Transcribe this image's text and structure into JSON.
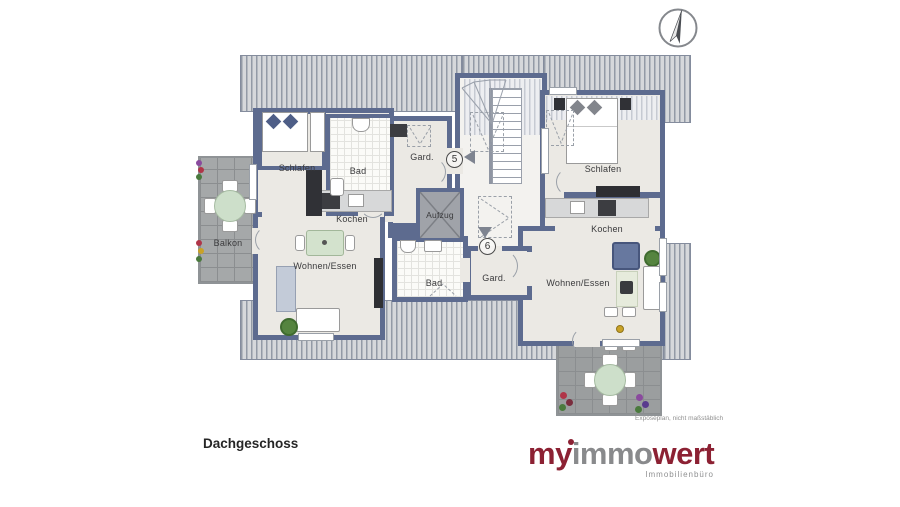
{
  "plan": {
    "floor_label": "Dachgeschoss",
    "caption": "Exposéplan, nicht maßstäblich",
    "core": {
      "elevator_label": "Aufzug"
    },
    "apartment_5": {
      "unit_number": "5",
      "schlafen": "Schlafen",
      "bad": "Bad",
      "kochen": "Kochen",
      "gard": "Gard.",
      "wohnen": "Wohnen/Essen",
      "balkon": "Balkon"
    },
    "apartment_6": {
      "unit_number": "6",
      "schlafen": "Schlafen",
      "bad": "Bad",
      "kochen": "Kochen",
      "gard": "Gard.",
      "wohnen": "Wohnen/Essen"
    },
    "colors": {
      "wall": "#5d6b8f",
      "floor": "#ebe9e4",
      "roof_stripe": "#939aa6",
      "brand_red": "#8c2133"
    }
  },
  "logo": {
    "part_my": "my",
    "part_immo": "immo",
    "part_wert": "wert",
    "subtitle": "Immobilienbüro"
  }
}
